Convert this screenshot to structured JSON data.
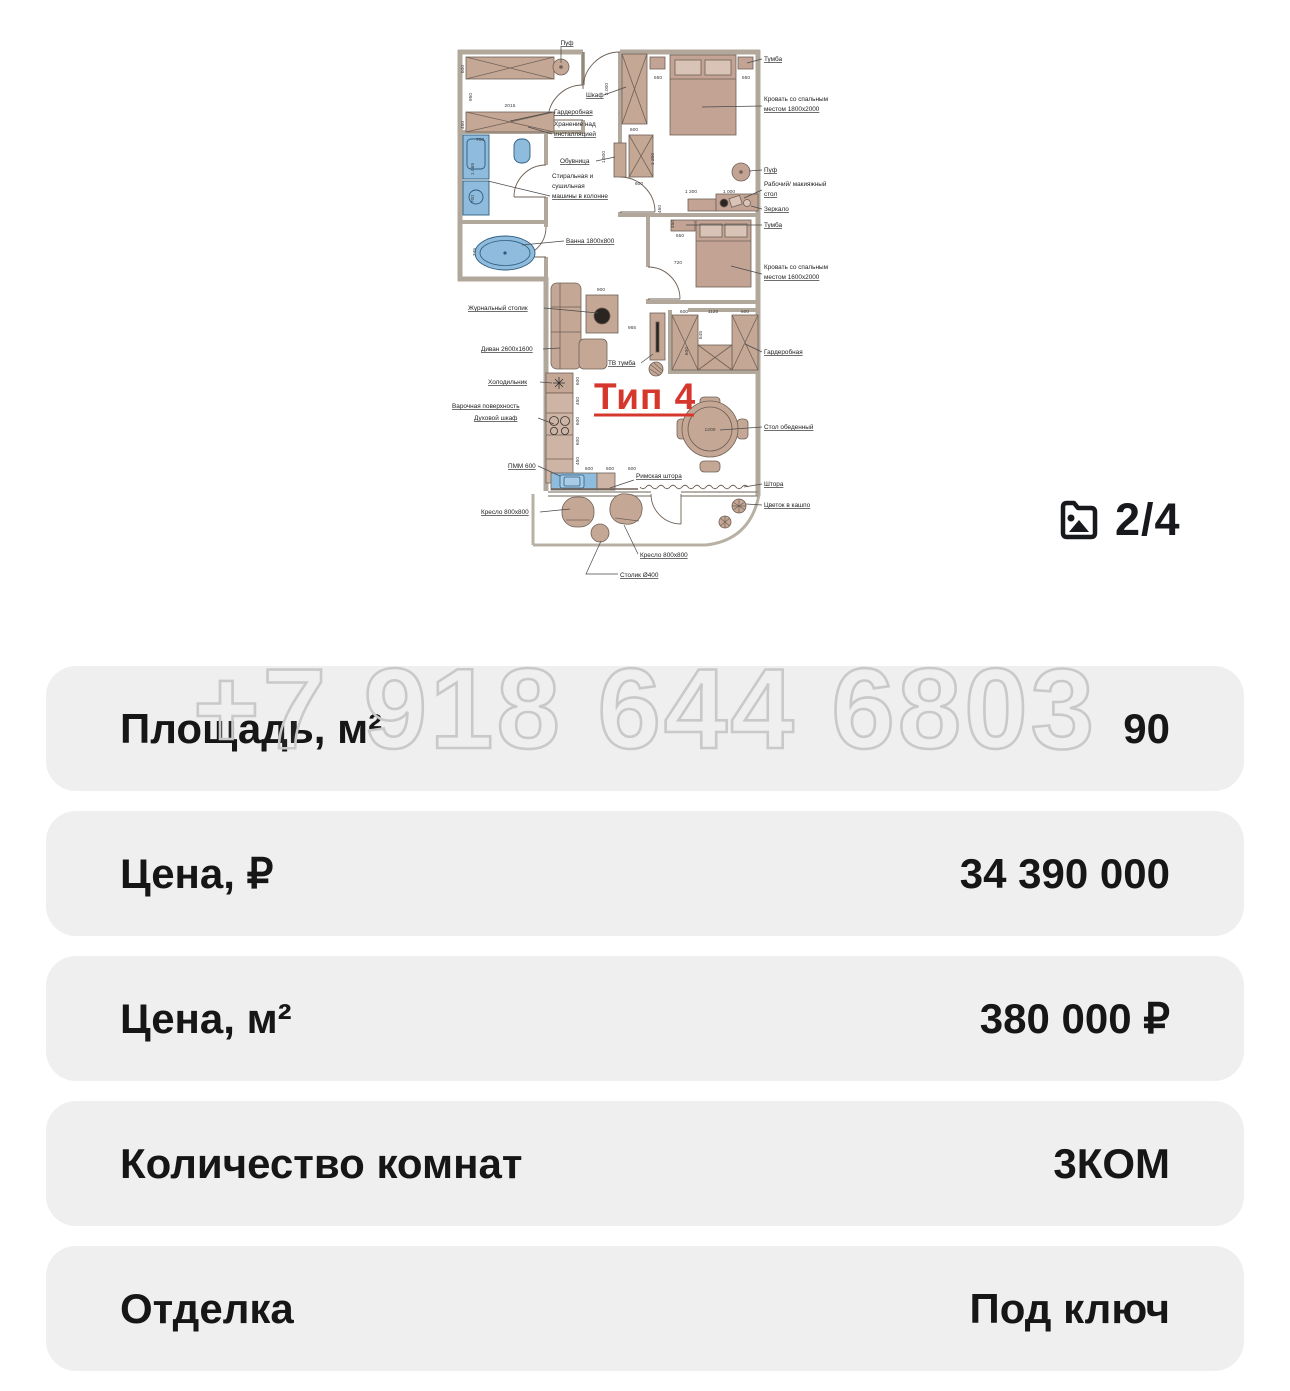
{
  "photo_counter": {
    "text": "2/4"
  },
  "watermark": {
    "text": "+7 918 644 6803"
  },
  "rows": [
    {
      "label": "Площадь, м²",
      "value": "90"
    },
    {
      "label": "Цена, ₽",
      "value": "34 390 000"
    },
    {
      "label": "Цена, м²",
      "value": "380 000 ₽"
    },
    {
      "label": "Количество комнат",
      "value": "3КОМ"
    },
    {
      "label": "Отделка",
      "value": "Под ключ"
    }
  ],
  "colors": {
    "row_background": "#efefef",
    "text": "#161616",
    "plan_wall": "#b1a89b",
    "plan_furniture": "#c5a795",
    "plan_fixture_blue": "#8fbcdc",
    "plan_accent_red": "#d6372c",
    "watermark_stroke": "#c9c9c9"
  },
  "plan": {
    "type_label": "Тип 4",
    "labels": [
      {
        "t": "Пуф",
        "x": 119,
        "y": 28,
        "a": "middle",
        "u": 1
      },
      {
        "t": "Шкаф",
        "x": 138,
        "y": 80,
        "a": "start",
        "u": 1
      },
      {
        "t": "Гардеробная",
        "x": 106,
        "y": 97,
        "a": "start",
        "u": 1
      },
      {
        "t": "Хранение над",
        "x": 106,
        "y": 109,
        "a": "start"
      },
      {
        "t": "инсталляцией",
        "x": 106,
        "y": 119,
        "a": "start",
        "u": 1
      },
      {
        "t": "Обувница",
        "x": 112,
        "y": 146,
        "a": "start",
        "u": 1
      },
      {
        "t": "Стиральная и",
        "x": 104,
        "y": 161,
        "a": "start"
      },
      {
        "t": "сушильная",
        "x": 104,
        "y": 171,
        "a": "start"
      },
      {
        "t": "машины в колонне",
        "x": 104,
        "y": 181,
        "a": "start",
        "u": 1
      },
      {
        "t": "Ванна 1800x800",
        "x": 118,
        "y": 226,
        "a": "start",
        "u": 1
      },
      {
        "t": "Журнальный столик",
        "x": 20,
        "y": 293,
        "a": "start",
        "u": 1
      },
      {
        "t": "Диван 2600x1600",
        "x": 33,
        "y": 334,
        "a": "start",
        "u": 1
      },
      {
        "t": "Холодильник",
        "x": 40,
        "y": 367,
        "a": "start",
        "u": 1
      },
      {
        "t": "Варочная поверхность",
        "x": 4,
        "y": 391,
        "a": "start",
        "u": 1
      },
      {
        "t": "Духовой шкаф",
        "x": 26,
        "y": 403,
        "a": "start",
        "u": 1
      },
      {
        "t": "ПММ 600",
        "x": 60,
        "y": 451,
        "a": "start",
        "u": 1
      },
      {
        "t": "Кресло 800x800",
        "x": 33,
        "y": 497,
        "a": "start",
        "u": 1
      },
      {
        "t": "ТВ тумба",
        "x": 160,
        "y": 348,
        "a": "start",
        "u": 1
      },
      {
        "t": "Римская штора",
        "x": 188,
        "y": 461,
        "a": "start",
        "u": 1
      },
      {
        "t": "Штора",
        "x": 316,
        "y": 469,
        "a": "start",
        "u": 1
      },
      {
        "t": "Цветок в кашпо",
        "x": 316,
        "y": 490,
        "a": "start",
        "u": 1
      },
      {
        "t": "Кресло 800x800",
        "x": 192,
        "y": 540,
        "a": "start",
        "u": 1
      },
      {
        "t": "Столик Ø400",
        "x": 172,
        "y": 560,
        "a": "start",
        "u": 1
      },
      {
        "t": "Тумба",
        "x": 316,
        "y": 44,
        "a": "start",
        "u": 1
      },
      {
        "t": "Кровать со спальным",
        "x": 316,
        "y": 84,
        "a": "start"
      },
      {
        "t": "местом 1800x2000",
        "x": 316,
        "y": 94,
        "a": "start",
        "u": 1
      },
      {
        "t": "Пуф",
        "x": 316,
        "y": 155,
        "a": "start",
        "u": 1
      },
      {
        "t": "Рабочий/ макияжный",
        "x": 316,
        "y": 169,
        "a": "start"
      },
      {
        "t": "стол",
        "x": 316,
        "y": 179,
        "a": "start",
        "u": 1
      },
      {
        "t": "Зеркало",
        "x": 316,
        "y": 194,
        "a": "start",
        "u": 1
      },
      {
        "t": "Тумба",
        "x": 316,
        "y": 210,
        "a": "start",
        "u": 1
      },
      {
        "t": "Кровать со спальным",
        "x": 316,
        "y": 252,
        "a": "start"
      },
      {
        "t": "местом 1600x2000",
        "x": 316,
        "y": 262,
        "a": "start",
        "u": 1
      },
      {
        "t": "Гардеробная",
        "x": 316,
        "y": 337,
        "a": "start",
        "u": 1
      },
      {
        "t": "Стол обеденный",
        "x": 316,
        "y": 412,
        "a": "start",
        "u": 1
      }
    ],
    "dims": [
      {
        "t": "600",
        "x": 16,
        "y": 52,
        "r": -90
      },
      {
        "t": "950",
        "x": 24,
        "y": 80,
        "r": -90
      },
      {
        "t": "2015",
        "x": 62,
        "y": 90
      },
      {
        "t": "450",
        "x": 16,
        "y": 108,
        "r": -90
      },
      {
        "t": "700",
        "x": 32,
        "y": 124
      },
      {
        "t": "1.065",
        "x": 26,
        "y": 152,
        "r": -90
      },
      {
        "t": "700",
        "x": 26,
        "y": 182,
        "r": -90
      },
      {
        "t": "745",
        "x": 28,
        "y": 235,
        "r": -90
      },
      {
        "t": "2.000",
        "x": 160,
        "y": 72,
        "r": -90
      },
      {
        "t": "600",
        "x": 186,
        "y": 114
      },
      {
        "t": "1.500",
        "x": 157,
        "y": 140,
        "r": -90
      },
      {
        "t": "550",
        "x": 210,
        "y": 62
      },
      {
        "t": "550",
        "x": 298,
        "y": 62
      },
      {
        "t": "1 200",
        "x": 206,
        "y": 142,
        "r": -90
      },
      {
        "t": "600",
        "x": 191,
        "y": 168
      },
      {
        "t": "1 200",
        "x": 243,
        "y": 176
      },
      {
        "t": "1 000",
        "x": 281,
        "y": 176
      },
      {
        "t": "460",
        "x": 213,
        "y": 192,
        "r": -90
      },
      {
        "t": "450",
        "x": 226,
        "y": 207,
        "r": -90
      },
      {
        "t": "650",
        "x": 232,
        "y": 220
      },
      {
        "t": "720",
        "x": 230,
        "y": 247
      },
      {
        "t": "600",
        "x": 236,
        "y": 296
      },
      {
        "t": "1120",
        "x": 265,
        "y": 296
      },
      {
        "t": "600",
        "x": 297,
        "y": 296
      },
      {
        "t": "845",
        "x": 254,
        "y": 318,
        "r": -90
      },
      {
        "t": "600",
        "x": 240,
        "y": 334,
        "r": -90
      },
      {
        "t": "965",
        "x": 184,
        "y": 312
      },
      {
        "t": "900",
        "x": 153,
        "y": 274
      },
      {
        "t": "600",
        "x": 131,
        "y": 364,
        "r": -90
      },
      {
        "t": "450",
        "x": 131,
        "y": 384,
        "r": -90
      },
      {
        "t": "600",
        "x": 131,
        "y": 404,
        "r": -90
      },
      {
        "t": "600",
        "x": 131,
        "y": 424,
        "r": -90
      },
      {
        "t": "450",
        "x": 131,
        "y": 444,
        "r": -90
      },
      {
        "t": "600",
        "x": 141,
        "y": 453
      },
      {
        "t": "600",
        "x": 162,
        "y": 453
      },
      {
        "t": "600",
        "x": 184,
        "y": 453
      },
      {
        "t": "1200",
        "x": 262,
        "y": 414
      }
    ]
  }
}
